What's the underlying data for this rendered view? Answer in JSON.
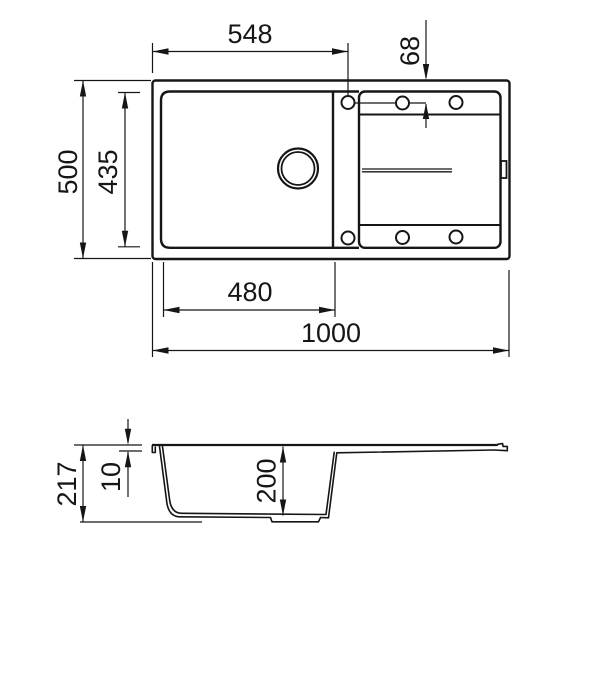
{
  "document": {
    "type": "technical dimension drawing of kitchen sink with drainer",
    "background": "#ffffff",
    "line_color": "#161616"
  },
  "top_view": {
    "dimensions": {
      "drain_center_from_left": "548",
      "tap_hole_inset": "68",
      "overall_depth": "500",
      "bowl_inner_depth": "435",
      "bowl_inner_width": "480",
      "overall_width": "1000"
    }
  },
  "section_view": {
    "dimensions": {
      "overall_height": "217",
      "rim_height": "10",
      "bowl_depth": "200"
    }
  }
}
